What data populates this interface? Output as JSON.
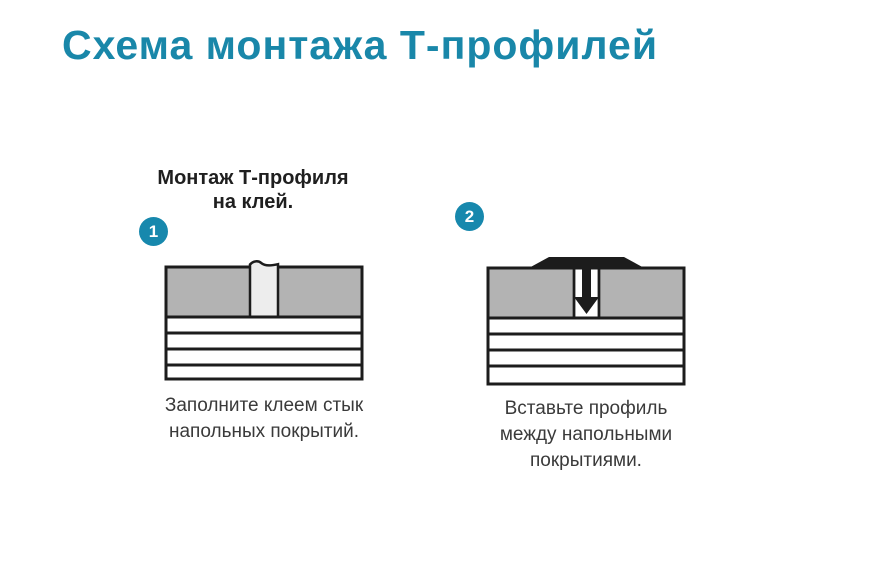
{
  "title": "Схема монтажа Т-профилей",
  "colors": {
    "accent": "#1987a9",
    "badge": "#1788ad",
    "ink": "#1c1c1c",
    "floor": "#b3b3b3",
    "glue": "#ededed",
    "heading": "#1f1f1f",
    "caption": "#3a3a3a",
    "background": "#ffffff"
  },
  "steps": [
    {
      "number": "1",
      "heading_lines": [
        "Монтаж Т-профиля",
        "на клей."
      ],
      "caption_lines": [
        "Заполните клеем стык",
        "напольных покрытий."
      ],
      "illustration": "glue-filled-joint"
    },
    {
      "number": "2",
      "caption_lines": [
        "Вставьте профиль",
        "между напольными",
        "покрытиями."
      ],
      "illustration": "t-profile-inserted-between-floorings"
    }
  ]
}
